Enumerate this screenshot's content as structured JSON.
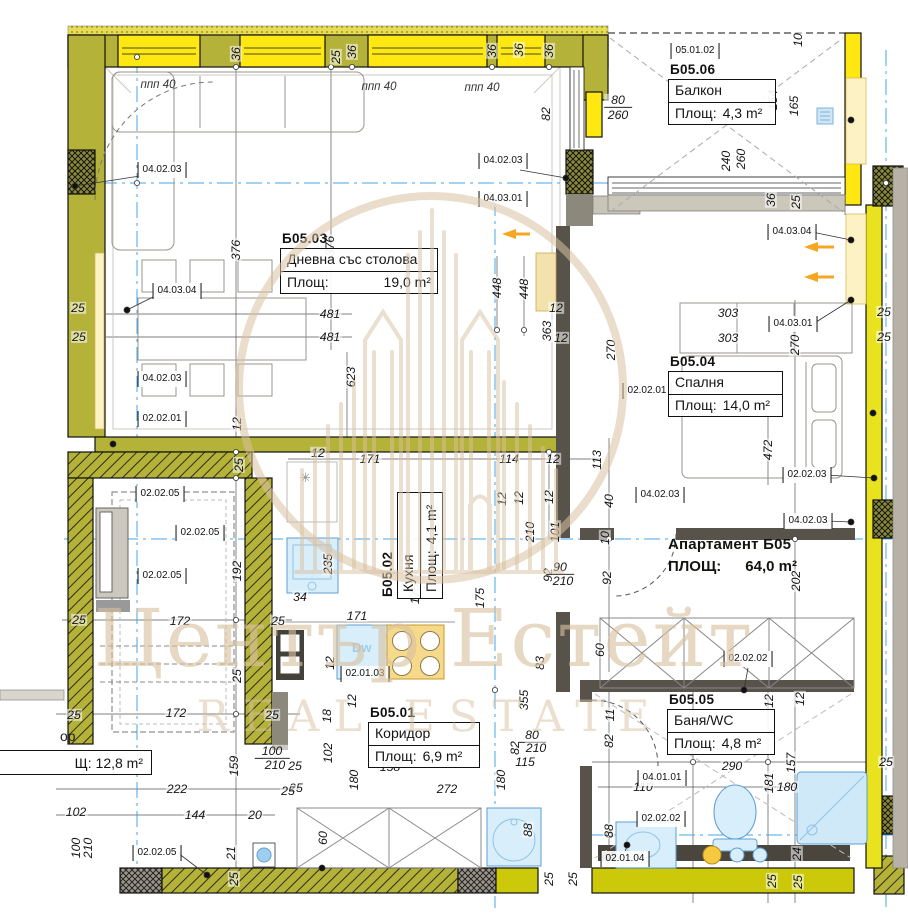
{
  "watermark": {
    "title": "Център Естейт",
    "subtitle": "REAL ESTATE",
    "color": "#d8c1a0"
  },
  "apartment": {
    "name": "Апартамент Б05",
    "area_label": "ПЛОЩ:",
    "area_value": "64,0 m²"
  },
  "rooms": [
    {
      "id": "Б05.03",
      "name": "Дневна със столова",
      "area_label": "Площ:",
      "area_value": "19,0 m²",
      "x": 280,
      "y": 231,
      "w": 158,
      "spread": true
    },
    {
      "id": "Б05.06",
      "name": "Балкон",
      "area_label": "Площ:",
      "area_value": "4,3 m²",
      "x": 668,
      "y": 62,
      "w": 108
    },
    {
      "id": "Б05.04",
      "name": "Спалня",
      "area_label": "Площ:",
      "area_value": "14,0 m²",
      "x": 668,
      "y": 354,
      "w": 115
    },
    {
      "id": "Б05.02",
      "name": "Кухня",
      "area_label": "Площ:",
      "area_value": "4,1 m²",
      "x": 358,
      "y": 514,
      "w": 107,
      "rot": true
    },
    {
      "id": "Б05.01",
      "name": "Коридор",
      "area_label": "Площ:",
      "area_value": "6,9 m²",
      "x": 368,
      "y": 705,
      "w": 112
    },
    {
      "id": "Б05.05",
      "name": "Баня/WC",
      "area_label": "Площ:",
      "area_value": "4,8 m²",
      "x": 667,
      "y": 692,
      "w": 108
    }
  ],
  "partial_room": {
    "header": "ор",
    "area": "Щ: 12,8 m²"
  },
  "symbols": {
    "fridge": "✳",
    "dishwasher": "Dw"
  },
  "window_labels": [
    {
      "text": "ппп 40",
      "x": 158,
      "y": 85
    },
    {
      "text": "ппп 40",
      "x": 379,
      "y": 87
    },
    {
      "text": "ппп 40",
      "x": 482,
      "y": 88
    }
  ],
  "codes": [
    {
      "t": "04.02.03",
      "x": 162,
      "y": 170
    },
    {
      "t": "04.02.03",
      "x": 503,
      "y": 161
    },
    {
      "t": "04.03.01",
      "x": 503,
      "y": 199
    },
    {
      "t": "04.03.04",
      "x": 177,
      "y": 291
    },
    {
      "t": "04.02.03",
      "x": 162,
      "y": 379
    },
    {
      "t": "02.02.01",
      "x": 162,
      "y": 419
    },
    {
      "t": "05.01.02",
      "x": 695,
      "y": 51
    },
    {
      "t": "04.03.04",
      "x": 792,
      "y": 232
    },
    {
      "t": "04.03.01",
      "x": 793,
      "y": 324
    },
    {
      "t": "02.02.01",
      "x": 647,
      "y": 391
    },
    {
      "t": "02.02.03",
      "x": 807,
      "y": 475
    },
    {
      "t": "04.02.03",
      "x": 660,
      "y": 495
    },
    {
      "t": "04.02.03",
      "x": 808,
      "y": 521
    },
    {
      "t": "02.02.02",
      "x": 748,
      "y": 659
    },
    {
      "t": "02.02.05",
      "x": 160,
      "y": 494
    },
    {
      "t": "02.02.05",
      "x": 200,
      "y": 533
    },
    {
      "t": "02.02.05",
      "x": 162,
      "y": 576
    },
    {
      "t": "02.02.05",
      "x": 157,
      "y": 853
    },
    {
      "t": "02.01.03",
      "x": 365,
      "y": 674
    },
    {
      "t": "04.01.01",
      "x": 662,
      "y": 778
    },
    {
      "t": "02.02.02",
      "x": 661,
      "y": 819
    },
    {
      "t": "02.01.04",
      "x": 625,
      "y": 859
    }
  ],
  "dims": [
    {
      "t": "36",
      "x": 236,
      "y": 54,
      "r": 1
    },
    {
      "t": "25",
      "x": 336,
      "y": 57,
      "r": 1
    },
    {
      "t": "36",
      "x": 352,
      "y": 52,
      "r": 1
    },
    {
      "t": "36",
      "x": 492,
      "y": 51,
      "r": 1
    },
    {
      "t": "36",
      "x": 519,
      "y": 50,
      "r": 1
    },
    {
      "t": "36",
      "x": 549,
      "y": 51,
      "r": 1
    },
    {
      "t": "82",
      "x": 546,
      "y": 114,
      "r": 1
    },
    {
      "t": "10",
      "x": 798,
      "y": 40,
      "r": 1
    },
    {
      "t": "154",
      "x": 773,
      "y": 100,
      "r": 1
    },
    {
      "t": "165",
      "x": 794,
      "y": 106,
      "r": 1
    },
    {
      "t": "80",
      "x": 618,
      "y": 101,
      "ul": 1
    },
    {
      "t": "260",
      "x": 618,
      "y": 115
    },
    {
      "t": "240",
      "x": 726,
      "y": 161,
      "r": 1
    },
    {
      "t": "260",
      "x": 741,
      "y": 159,
      "r": 1
    },
    {
      "t": "36",
      "x": 771,
      "y": 200,
      "r": 1
    },
    {
      "t": "25",
      "x": 796,
      "y": 202,
      "r": 1
    },
    {
      "t": "25",
      "x": 78,
      "y": 308
    },
    {
      "t": "25",
      "x": 79,
      "y": 337
    },
    {
      "t": "376",
      "x": 236,
      "y": 250,
      "r": 1
    },
    {
      "t": "376",
      "x": 330,
      "y": 246,
      "r": 1
    },
    {
      "t": "481",
      "x": 330,
      "y": 314
    },
    {
      "t": "481",
      "x": 330,
      "y": 337
    },
    {
      "t": "623",
      "x": 351,
      "y": 377,
      "r": 1
    },
    {
      "t": "448",
      "x": 497,
      "y": 288,
      "r": 1
    },
    {
      "t": "448",
      "x": 524,
      "y": 289,
      "r": 1
    },
    {
      "t": "12",
      "x": 556,
      "y": 308
    },
    {
      "t": "363",
      "x": 547,
      "y": 331,
      "r": 1
    },
    {
      "t": "12",
      "x": 561,
      "y": 338
    },
    {
      "t": "270",
      "x": 611,
      "y": 350,
      "r": 1
    },
    {
      "t": "270",
      "x": 795,
      "y": 345,
      "r": 1
    },
    {
      "t": "303",
      "x": 728,
      "y": 313
    },
    {
      "t": "303",
      "x": 728,
      "y": 338
    },
    {
      "t": "25",
      "x": 884,
      "y": 312
    },
    {
      "t": "25",
      "x": 884,
      "y": 337
    },
    {
      "t": "472",
      "x": 768,
      "y": 450,
      "r": 1
    },
    {
      "t": "113",
      "x": 597,
      "y": 460,
      "r": 1
    },
    {
      "t": "40",
      "x": 609,
      "y": 501,
      "r": 1
    },
    {
      "t": "10",
      "x": 605,
      "y": 538,
      "r": 1
    },
    {
      "t": "92",
      "x": 607,
      "y": 578,
      "r": 1
    },
    {
      "t": "202",
      "x": 796,
      "y": 581,
      "r": 1
    },
    {
      "t": "12",
      "x": 318,
      "y": 453
    },
    {
      "t": "171",
      "x": 370,
      "y": 459
    },
    {
      "t": "114",
      "x": 509,
      "y": 459
    },
    {
      "t": "12",
      "x": 553,
      "y": 459
    },
    {
      "t": "12",
      "x": 502,
      "y": 499,
      "r": 1
    },
    {
      "t": "12",
      "x": 519,
      "y": 498,
      "r": 1
    },
    {
      "t": "12",
      "x": 549,
      "y": 497,
      "r": 1
    },
    {
      "t": "210",
      "x": 530,
      "y": 532,
      "r": 1
    },
    {
      "t": "101",
      "x": 555,
      "y": 532,
      "r": 1
    },
    {
      "t": "235",
      "x": 328,
      "y": 564,
      "r": 1
    },
    {
      "t": "34",
      "x": 300,
      "y": 597
    },
    {
      "t": "175",
      "x": 415,
      "y": 594,
      "r": 1
    },
    {
      "t": "175",
      "x": 480,
      "y": 598,
      "r": 1
    },
    {
      "t": "92",
      "x": 548,
      "y": 575,
      "r": 1
    },
    {
      "t": "90",
      "x": 560,
      "y": 568,
      "ul": 1
    },
    {
      "t": "210",
      "x": 563,
      "y": 581
    },
    {
      "t": "171",
      "x": 357,
      "y": 616
    },
    {
      "t": "12",
      "x": 330,
      "y": 663,
      "r": 1
    },
    {
      "t": "60",
      "x": 600,
      "y": 650,
      "r": 1
    },
    {
      "t": "83",
      "x": 540,
      "y": 663,
      "r": 1
    },
    {
      "t": "12",
      "x": 352,
      "y": 701,
      "r": 1
    },
    {
      "t": "18",
      "x": 327,
      "y": 716,
      "r": 1
    },
    {
      "t": "102",
      "x": 328,
      "y": 753,
      "r": 1
    },
    {
      "t": "25",
      "x": 295,
      "y": 766
    },
    {
      "t": "25",
      "x": 296,
      "y": 788
    },
    {
      "t": "158",
      "x": 390,
      "y": 767
    },
    {
      "t": "272",
      "x": 447,
      "y": 789
    },
    {
      "t": "115",
      "x": 525,
      "y": 762
    },
    {
      "t": "180",
      "x": 354,
      "y": 780,
      "r": 1
    },
    {
      "t": "180",
      "x": 501,
      "y": 780,
      "r": 1
    },
    {
      "t": "355",
      "x": 524,
      "y": 700,
      "r": 1
    },
    {
      "t": "60",
      "x": 323,
      "y": 838,
      "r": 1
    },
    {
      "t": "88",
      "x": 528,
      "y": 830,
      "r": 1
    },
    {
      "t": "25",
      "x": 549,
      "y": 879,
      "r": 1
    },
    {
      "t": "25",
      "x": 573,
      "y": 879,
      "r": 1
    },
    {
      "t": "82",
      "x": 515,
      "y": 748,
      "r": 1
    },
    {
      "t": "80",
      "x": 532,
      "y": 736,
      "ul": 1
    },
    {
      "t": "210",
      "x": 536,
      "y": 748
    },
    {
      "t": "12",
      "x": 237,
      "y": 424,
      "r": 1
    },
    {
      "t": "25",
      "x": 239,
      "y": 465,
      "r": 1
    },
    {
      "t": "192",
      "x": 237,
      "y": 571,
      "r": 1
    },
    {
      "t": "25",
      "x": 79,
      "y": 620
    },
    {
      "t": "172",
      "x": 180,
      "y": 621
    },
    {
      "t": "25",
      "x": 278,
      "y": 621
    },
    {
      "t": "25",
      "x": 237,
      "y": 676,
      "r": 1
    },
    {
      "t": "25",
      "x": 74,
      "y": 715
    },
    {
      "t": "172",
      "x": 176,
      "y": 713
    },
    {
      "t": "25",
      "x": 272,
      "y": 715
    },
    {
      "t": "100",
      "x": 272,
      "y": 752,
      "ul": 1
    },
    {
      "t": "210",
      "x": 275,
      "y": 765
    },
    {
      "t": "159",
      "x": 234,
      "y": 766,
      "r": 1
    },
    {
      "t": "222",
      "x": 177,
      "y": 789
    },
    {
      "t": "25",
      "x": 288,
      "y": 791
    },
    {
      "t": "102",
      "x": 76,
      "y": 812
    },
    {
      "t": "144",
      "x": 195,
      "y": 815
    },
    {
      "t": "20",
      "x": 255,
      "y": 815
    },
    {
      "t": "100",
      "x": 76,
      "y": 848,
      "r": 1
    },
    {
      "t": "210",
      "x": 88,
      "y": 848,
      "r": 1
    },
    {
      "t": "21",
      "x": 231,
      "y": 853,
      "r": 1
    },
    {
      "t": "25",
      "x": 234,
      "y": 879,
      "r": 1
    },
    {
      "t": "12",
      "x": 769,
      "y": 701,
      "r": 1
    },
    {
      "t": "12",
      "x": 800,
      "y": 699,
      "r": 1
    },
    {
      "t": "82",
      "x": 609,
      "y": 741,
      "r": 1
    },
    {
      "t": "11",
      "x": 610,
      "y": 715,
      "r": 1
    },
    {
      "t": "110",
      "x": 643,
      "y": 787
    },
    {
      "t": "290",
      "x": 732,
      "y": 766
    },
    {
      "t": "181",
      "x": 769,
      "y": 783,
      "r": 1
    },
    {
      "t": "180",
      "x": 787,
      "y": 787
    },
    {
      "t": "157",
      "x": 791,
      "y": 763,
      "r": 1
    },
    {
      "t": "25",
      "x": 886,
      "y": 762
    },
    {
      "t": "88",
      "x": 609,
      "y": 831,
      "r": 1
    },
    {
      "t": "24",
      "x": 797,
      "y": 854,
      "r": 1
    },
    {
      "t": "25",
      "x": 772,
      "y": 881,
      "r": 1
    },
    {
      "t": "25",
      "x": 798,
      "y": 882,
      "r": 1
    }
  ]
}
